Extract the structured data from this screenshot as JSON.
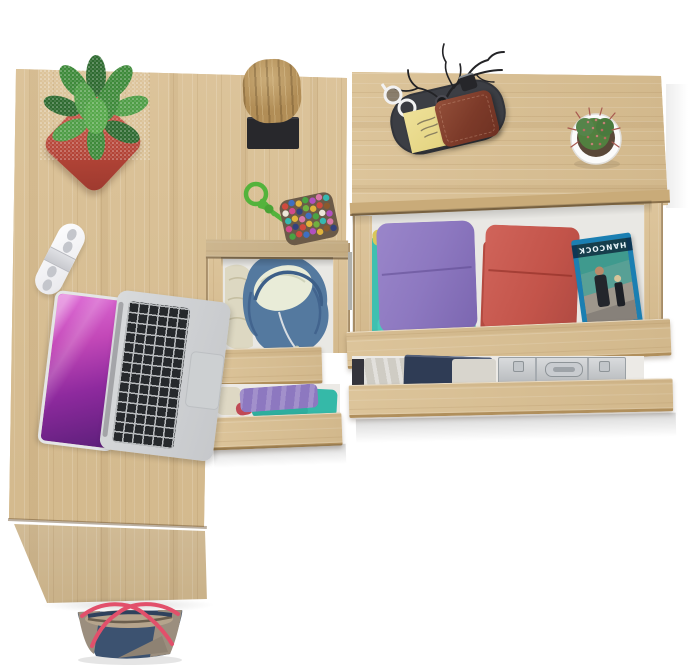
{
  "scene": {
    "type": "product-photo-top-view",
    "description": "Top-down render of a light Sonoma-oak corner desk and matching chest with open drawers holding folded clothes and everyday objects",
    "background_color": "#ffffff"
  },
  "palette": {
    "oak_wood": "#d9c197",
    "oak_wood_edge": "#c9ab79",
    "drawer_interior": "#e9e8e4",
    "pot_red": "#c0544a",
    "plant_green": "#3e8a3a",
    "hoodie_blue": "#54799f",
    "hoodie_lining": "#e9ecd8",
    "clothes_purple": "#8d78c0",
    "clothes_teal": "#3fc0b0",
    "clothes_magenta": "#c2497c",
    "clothes_red": "#c6554a",
    "dvd_case_blue": "#1b7fb2",
    "briefcase_silver": "#c6c9cc",
    "bag_navy": "#3c5270",
    "bag_taupe": "#9b8e7e",
    "bag_strap_pink": "#e2506b",
    "laptop_screen_magenta": "#c348b8",
    "rope_green": "#54b33c",
    "tray_dark": "#3c3e44",
    "wallet_brown": "#83422e",
    "sticky_note_yellow": "#e9da85"
  },
  "furniture": {
    "desk": {
      "label": "L-shaped oak desk"
    },
    "desk_side_panel": {
      "label": "desk side panel"
    },
    "desk_drawer_upper": {
      "label": "open desk drawer with blue hoodie"
    },
    "desk_drawer_lower": {
      "label": "open desk drawer with folded tops"
    },
    "chest": {
      "label": "oak chest of drawers"
    },
    "chest_drawer_upper": {
      "label": "open chest drawer with folded clothes and movie case"
    },
    "chest_drawer_lower": {
      "label": "slightly open chest drawer with clothes and aluminium case"
    }
  },
  "items": {
    "succulent": {
      "label": "speckled succulent in red square pot"
    },
    "log_decor": {
      "label": "driftwood log on black stand"
    },
    "white_gadget": {
      "label": "white capsule gadget"
    },
    "laptop": {
      "label": "open silver laptop with magenta wallpaper"
    },
    "pompom_pouch": {
      "label": "green cord pouch covered in multicolour pompoms"
    },
    "valet_tray": {
      "label": "dark oval valet tray"
    },
    "sunglasses": {
      "label": "white-framed sunglasses"
    },
    "sticky_notes": {
      "label": "yellow sticky-note pad with handwriting"
    },
    "wallet": {
      "label": "brown leather wallet"
    },
    "twig_stand": {
      "label": "black twig jewellery stand"
    },
    "watch": {
      "label": "dark wristwatch"
    },
    "lock": {
      "label": "small black combination lock"
    },
    "cactus": {
      "label": "red-spined cactus in round white pot"
    },
    "hoodie": {
      "label": "folded blue hoodie with cream lining"
    },
    "knit_cloth": {
      "label": "cream knit garment"
    },
    "clothes_stack_purple": {
      "label": "stack of folded purple, teal and pink tops"
    },
    "clothes_stack_red": {
      "label": "stack of folded red tops"
    },
    "dvd": {
      "title": "HANCOCK",
      "label": "blue movie case lying upside-down"
    },
    "gray_clothes": {
      "label": "folded grey and navy clothes"
    },
    "briefcase": {
      "label": "aluminium briefcase"
    },
    "handbag": {
      "label": "navy and taupe tote bag with pink straps"
    }
  }
}
